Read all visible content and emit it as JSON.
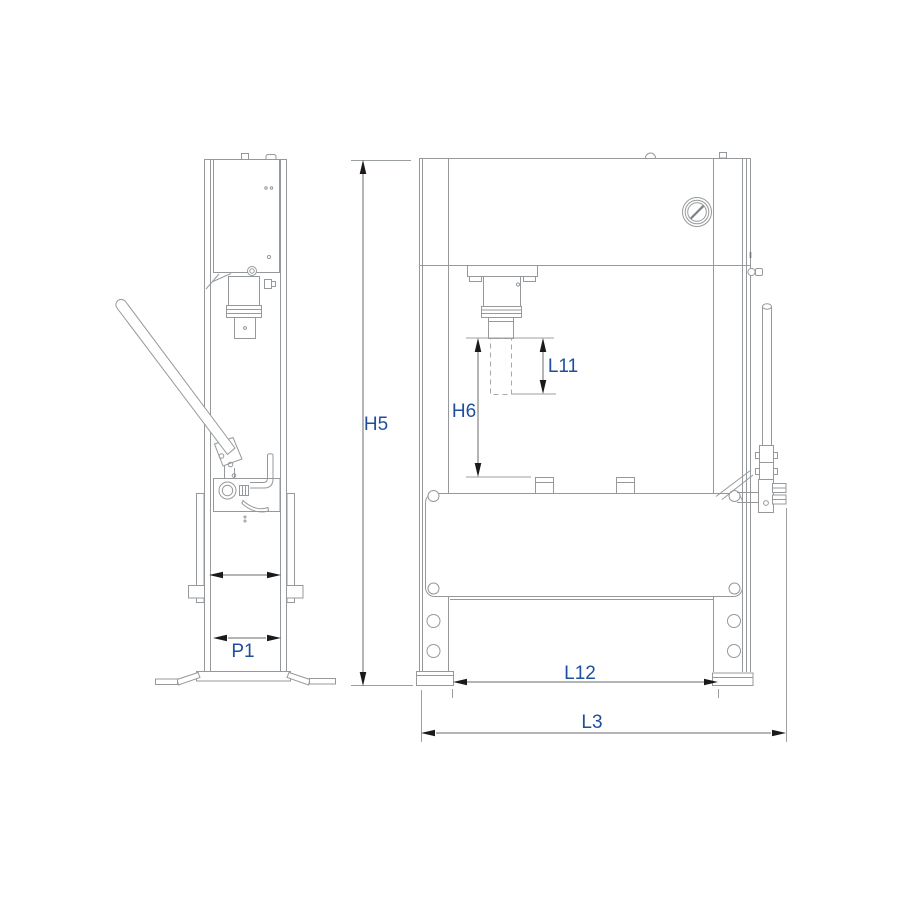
{
  "colors": {
    "label": "#1d4f9e",
    "drawing_lines": "#96999b",
    "dimension_lines": "#6a6a6a",
    "arrowheads": "#1a1a1a",
    "background": "#ffffff"
  },
  "dimensions": {
    "h5": {
      "label": "H5"
    },
    "h6": {
      "label": "H6"
    },
    "l11": {
      "label": "L11"
    },
    "p1": {
      "label": "P1"
    },
    "l12": {
      "label": "L12"
    },
    "l3": {
      "label": "L3"
    }
  }
}
